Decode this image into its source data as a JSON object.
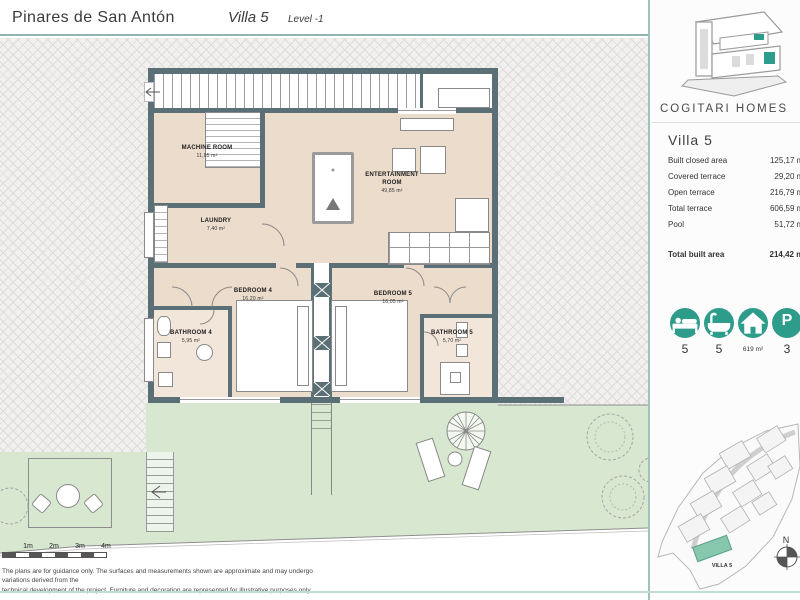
{
  "header": {
    "project_name": "Pinares de San Antón",
    "villa_name": "Villa 5",
    "level": "Level -1"
  },
  "sidebar": {
    "brand_name": "COGITARI HOMES",
    "villa_title": "Villa 5",
    "specs": [
      {
        "label": "Built closed area",
        "value": "125,17 m²"
      },
      {
        "label": "Covered terrace",
        "value": "29,20 m²"
      },
      {
        "label": "Open terrace",
        "value": "216,79 m²"
      },
      {
        "label": "Total terrace",
        "value": "606,59 m²"
      },
      {
        "label": "Pool",
        "value": "51,72 m²"
      }
    ],
    "total": {
      "label": "Total built area",
      "value": "214,42 m²"
    },
    "features": [
      {
        "icon": "bed-icon",
        "value": "5"
      },
      {
        "icon": "bathtub-icon",
        "value": "5"
      },
      {
        "icon": "house-icon",
        "value": "619 m²"
      },
      {
        "icon": "parking-icon",
        "value": "3"
      }
    ],
    "parking_letter": "P",
    "site_map": {
      "highlight_label": "VILLA 5",
      "compass": "N"
    }
  },
  "plan": {
    "rooms": {
      "machine": {
        "name": "MACHINE ROOM",
        "area": "11,65 m²"
      },
      "laundry": {
        "name": "LAUNDRY",
        "area": "7,40 m²"
      },
      "entertainment": {
        "name": "ENTERTAINMENT ROOM",
        "area": "49,85 m²"
      },
      "bedroom4": {
        "name": "BEDROOM 4",
        "area": "16,20 m²"
      },
      "bedroom5": {
        "name": "BEDROOM 5",
        "area": "16,05 m²"
      },
      "bathroom4": {
        "name": "BATHROOM 4",
        "area": "5,95 m²"
      },
      "bathroom5": {
        "name": "BATHROOM 5",
        "area": "5,70 m²"
      }
    },
    "scale_bar": {
      "labels": [
        "1m",
        "2m",
        "3m",
        "4m"
      ]
    },
    "disclaimer": {
      "line1": "The plans are for guidance only. The surfaces and measurements shown are approximate and may undergo variations derived from the",
      "line2": "technical development of the project. Furniture and decoration are represented for illustrative purposes only."
    }
  },
  "colors": {
    "accent_teal": "#2e9c8a",
    "wall": "#5a7076",
    "floor": "#ecdccb",
    "garden": "#d8e8d0",
    "map_highlight": "#86c7ae"
  }
}
